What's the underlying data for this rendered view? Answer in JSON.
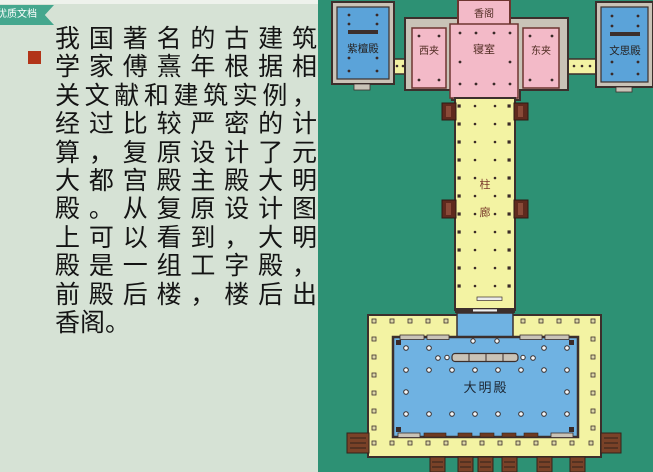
{
  "badge": {
    "label": "优质文档"
  },
  "content": {
    "lines": [
      "我国著名的古建筑",
      "学家傅熹年根据相",
      "关文献和建筑实例，",
      "经过比较严密的计",
      "算，复原设计了元",
      "大都宫殿主殿大明",
      "殿。从复原设计图",
      "上可以看到，大明",
      "殿是一组工字殿，",
      "前殿后楼，楼后出",
      "香阁。"
    ]
  },
  "plan": {
    "labels": {
      "xiangge": "香阁",
      "qinshi": "寝室",
      "xijia": "西夹",
      "dongjia": "东夹",
      "zitandian": "紫檀殿",
      "wensidian": "文思殿",
      "zhulang_top": "柱",
      "zhulang_bottom": "廊",
      "damingdian": "大明殿"
    },
    "colors": {
      "slide_bg": "#d6e2d5",
      "badge_teal": "#45a78e",
      "bullet_red": "#b23418",
      "ground": "#2d9174",
      "platform_yellow": "#f3f3a3",
      "room_pink": "#f3bac8",
      "hall_blue": "#6fb2e2",
      "building_blue": "#5ba3d9",
      "stone_gray": "#c9c3b7",
      "outline": "#3c2f2c",
      "stair_brown": "#7a4228"
    }
  }
}
